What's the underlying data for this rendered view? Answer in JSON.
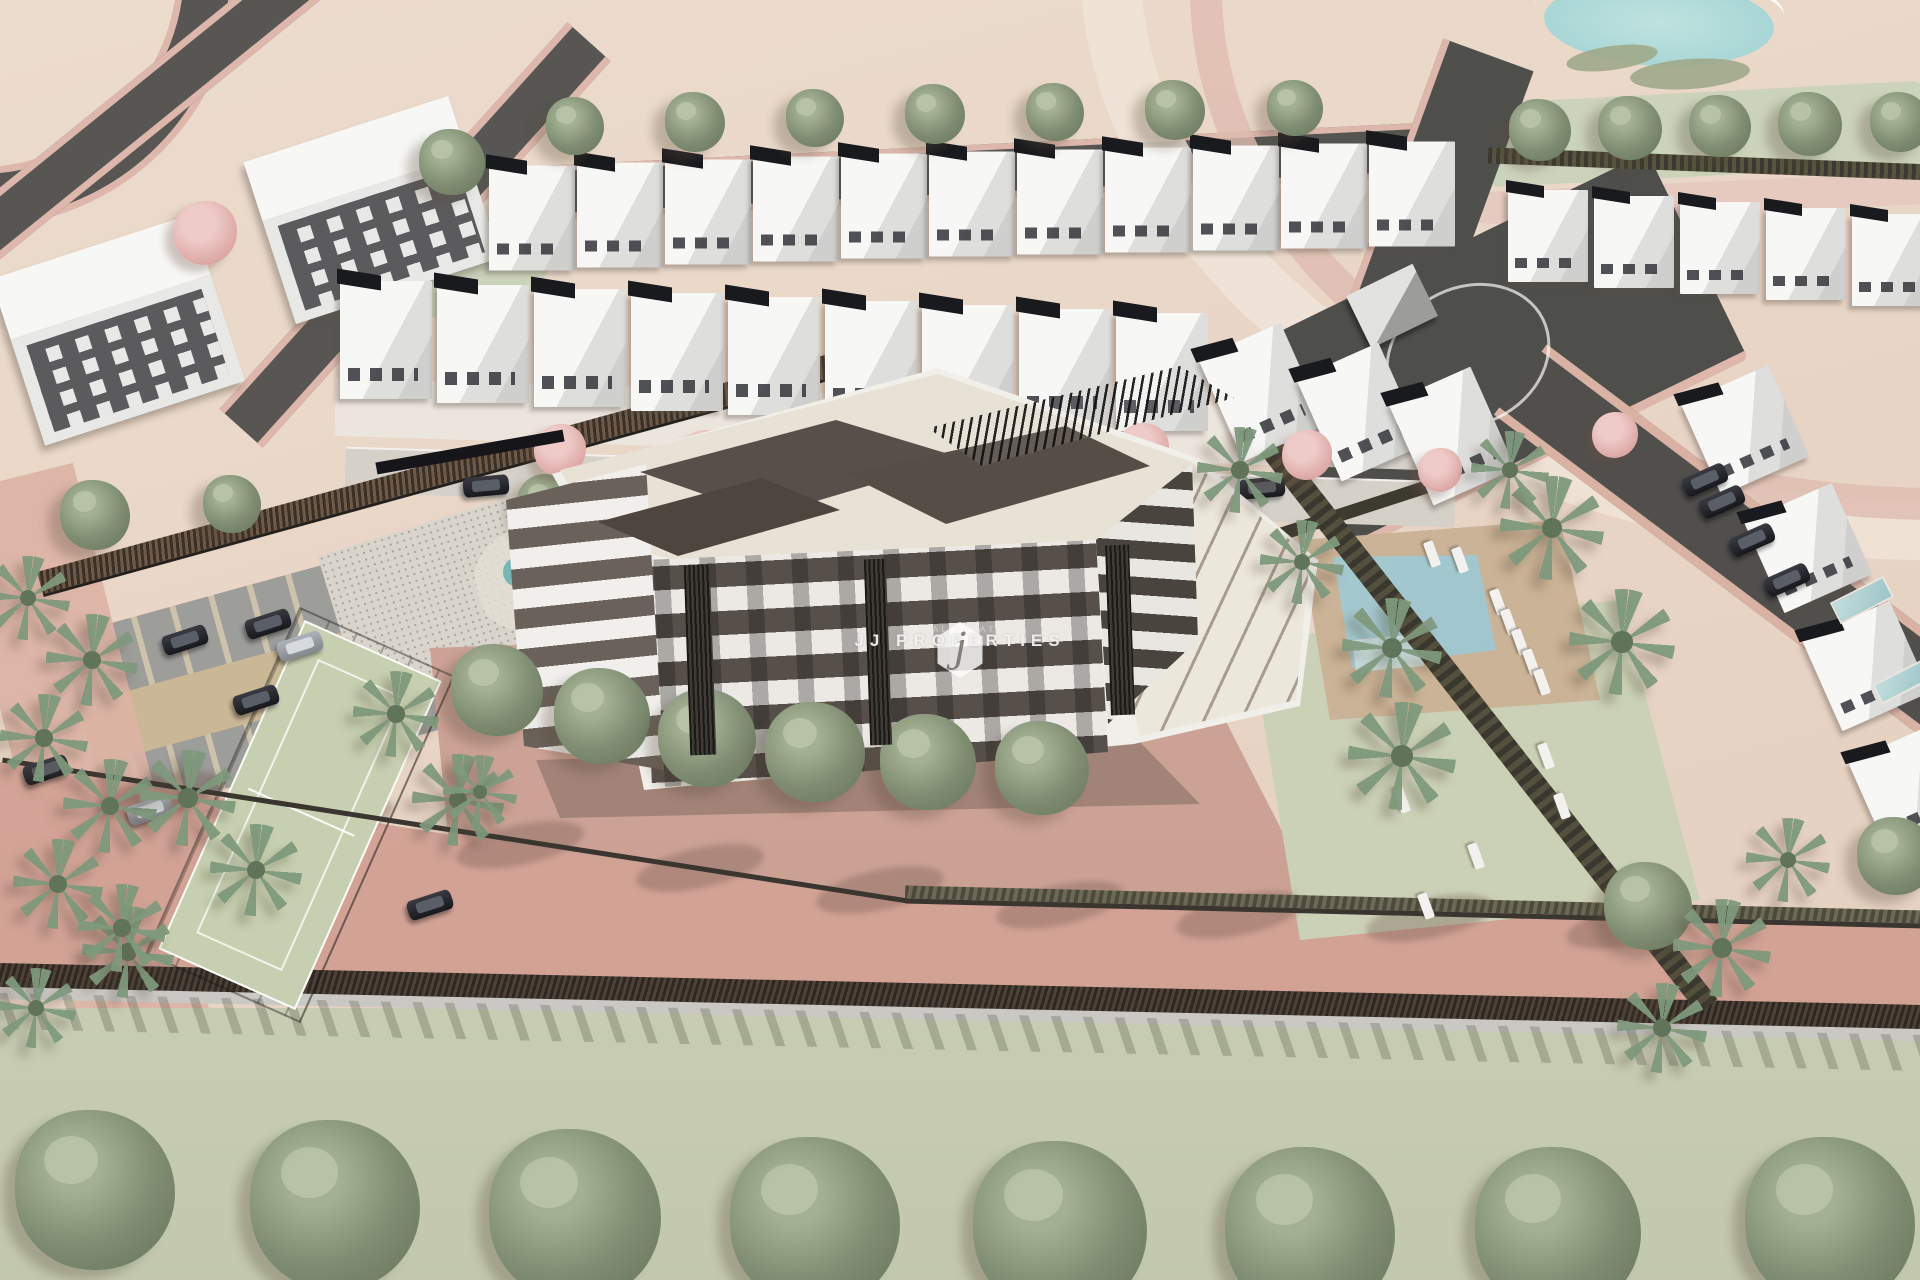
{
  "image": {
    "width": 1920,
    "height": 1280,
    "description": "Aerial 3D architectural rendering of a residential development: a central apartment building with cream roof terrace and brown penthouse volumes, surrounded by rows of white villas, a communal pool with sun loungers and palm trees, a paddle court, a parking lot with cars, playground, roads and a large green field along the bottom."
  },
  "watermark": {
    "logo_letter": "j",
    "brand": "JJ PROPERTIES",
    "tagline": "REAL ESTATE"
  },
  "palette": {
    "terrain": "#e8d5c5",
    "terrain_hi": "#ecdccd",
    "terrain_lo": "#e3cfbf",
    "road": "#575653",
    "sidewalk": "#ddb7ab",
    "roof_dark": "#191a1e",
    "tree": "#7f8d72",
    "flower": "#dda9a6",
    "field_green": "#ccd3bb",
    "roof_cream": "#e8e2d4",
    "brown": "#57504a",
    "pool": "#93bcc6",
    "deck": "#cab396",
    "lawn": "#cbd1b6",
    "stall": "#9d9d9a",
    "lane": "#c9b795",
    "court": "#c6d0b0",
    "walk_pink": "#dcb2a4",
    "pave_pink": "#cfa89a",
    "road_salmon": "#d6a89a",
    "wall_dark": "#4e4238",
    "wall_light": "#cac8c4",
    "field_bottom": "#c7ccb2",
    "sand": "#d9bd92"
  },
  "scene": {
    "sprites": [
      {
        "cls": "apt",
        "x": 372,
        "y": 210,
        "w": 215,
        "h": 170,
        "r": -18
      },
      {
        "cls": "apt",
        "x": 118,
        "y": 330,
        "w": 210,
        "h": 175,
        "r": -18
      },
      {
        "cls": "villa",
        "x": 532,
        "y": 218
      },
      {
        "cls": "villa",
        "x": 620,
        "y": 215
      },
      {
        "cls": "villa",
        "x": 708,
        "y": 212
      },
      {
        "cls": "villa",
        "x": 796,
        "y": 209
      },
      {
        "cls": "villa",
        "x": 884,
        "y": 206
      },
      {
        "cls": "villa",
        "x": 972,
        "y": 204
      },
      {
        "cls": "villa",
        "x": 1060,
        "y": 202
      },
      {
        "cls": "villa",
        "x": 1148,
        "y": 200
      },
      {
        "cls": "villa",
        "x": 1236,
        "y": 198
      },
      {
        "cls": "villa",
        "x": 1324,
        "y": 196
      },
      {
        "cls": "villa",
        "x": 1412,
        "y": 194
      },
      {
        "cls": "villa",
        "x": 386,
        "y": 340,
        "w": 92,
        "h": 118
      },
      {
        "cls": "villa",
        "x": 483,
        "y": 344,
        "w": 92,
        "h": 118
      },
      {
        "cls": "villa",
        "x": 580,
        "y": 348,
        "w": 92,
        "h": 118
      },
      {
        "cls": "villa",
        "x": 677,
        "y": 352,
        "w": 92,
        "h": 118
      },
      {
        "cls": "villa",
        "x": 774,
        "y": 356,
        "w": 92,
        "h": 118
      },
      {
        "cls": "villa",
        "x": 871,
        "y": 360,
        "w": 92,
        "h": 118
      },
      {
        "cls": "villa",
        "x": 968,
        "y": 364,
        "w": 92,
        "h": 118
      },
      {
        "cls": "villa",
        "x": 1065,
        "y": 368,
        "w": 92,
        "h": 118
      },
      {
        "cls": "villa",
        "x": 1162,
        "y": 372,
        "w": 92,
        "h": 118
      },
      {
        "cls": "villa",
        "x": 1262,
        "y": 392,
        "w": 90,
        "h": 112,
        "r": -24
      },
      {
        "cls": "villa",
        "x": 1360,
        "y": 412,
        "w": 90,
        "h": 112,
        "r": -24
      },
      {
        "cls": "villa",
        "x": 1452,
        "y": 436,
        "w": 90,
        "h": 112,
        "r": -24
      },
      {
        "cls": "villa",
        "x": 1548,
        "y": 236,
        "w": 80,
        "h": 92
      },
      {
        "cls": "villa",
        "x": 1634,
        "y": 242,
        "w": 80,
        "h": 92
      },
      {
        "cls": "villa",
        "x": 1720,
        "y": 248,
        "w": 80,
        "h": 92
      },
      {
        "cls": "villa",
        "x": 1806,
        "y": 254,
        "w": 80,
        "h": 92
      },
      {
        "cls": "villa",
        "x": 1892,
        "y": 260,
        "w": 80,
        "h": 92
      },
      {
        "cls": "villa",
        "x": 1745,
        "y": 430,
        "w": 96,
        "h": 100,
        "r": -24
      },
      {
        "cls": "villa",
        "x": 1808,
        "y": 548,
        "w": 96,
        "h": 100,
        "r": -24
      },
      {
        "cls": "villa",
        "x": 1866,
        "y": 666,
        "w": 96,
        "h": 100,
        "r": -24
      },
      {
        "cls": "villa",
        "x": 1912,
        "y": 788,
        "w": 96,
        "h": 100,
        "r": -24
      },
      {
        "cls": "tree",
        "x": 575,
        "y": 126,
        "w": 58,
        "h": 58
      },
      {
        "cls": "tree",
        "x": 695,
        "y": 122,
        "w": 60,
        "h": 60
      },
      {
        "cls": "tree",
        "x": 815,
        "y": 118,
        "w": 58,
        "h": 58
      },
      {
        "cls": "tree",
        "x": 935,
        "y": 114,
        "w": 60,
        "h": 60
      },
      {
        "cls": "tree",
        "x": 1055,
        "y": 112,
        "w": 58,
        "h": 58
      },
      {
        "cls": "tree",
        "x": 1175,
        "y": 110,
        "w": 60,
        "h": 60
      },
      {
        "cls": "tree",
        "x": 1295,
        "y": 108,
        "w": 56,
        "h": 56
      },
      {
        "cls": "tree",
        "x": 1540,
        "y": 130,
        "w": 62,
        "h": 62
      },
      {
        "cls": "tree",
        "x": 1630,
        "y": 128,
        "w": 64,
        "h": 64
      },
      {
        "cls": "tree",
        "x": 1720,
        "y": 126,
        "w": 62,
        "h": 62
      },
      {
        "cls": "tree",
        "x": 1810,
        "y": 124,
        "w": 64,
        "h": 64
      },
      {
        "cls": "tree",
        "x": 1900,
        "y": 122,
        "w": 60,
        "h": 60
      },
      {
        "cls": "tree",
        "x": 452,
        "y": 162,
        "w": 66,
        "h": 66
      },
      {
        "cls": "tree",
        "x": 548,
        "y": 505,
        "w": 62,
        "h": 62
      },
      {
        "cls": "tree",
        "x": 95,
        "y": 515,
        "w": 70,
        "h": 70
      },
      {
        "cls": "tree",
        "x": 232,
        "y": 504,
        "w": 58,
        "h": 58
      },
      {
        "cls": "tree",
        "x": 497,
        "y": 690,
        "w": 92,
        "h": 92,
        "z": 5
      },
      {
        "cls": "tree",
        "x": 602,
        "y": 716,
        "w": 96,
        "h": 96,
        "z": 5
      },
      {
        "cls": "tree",
        "x": 707,
        "y": 738,
        "w": 98,
        "h": 98,
        "z": 5
      },
      {
        "cls": "tree",
        "x": 815,
        "y": 752,
        "w": 100,
        "h": 100,
        "z": 5
      },
      {
        "cls": "tree",
        "x": 928,
        "y": 762,
        "w": 96,
        "h": 96,
        "z": 5
      },
      {
        "cls": "tree",
        "x": 1042,
        "y": 768,
        "w": 94,
        "h": 94,
        "z": 5
      },
      {
        "cls": "tree",
        "x": 1188,
        "y": 642,
        "w": 78,
        "h": 78
      },
      {
        "cls": "tree",
        "x": 1250,
        "y": 560,
        "w": 54,
        "h": 54
      },
      {
        "cls": "tree",
        "x": 1648,
        "y": 906,
        "w": 88,
        "h": 88
      },
      {
        "cls": "tree",
        "x": 1896,
        "y": 856,
        "w": 78,
        "h": 78
      },
      {
        "cls": "tree",
        "x": 95,
        "y": 1190,
        "w": 160,
        "h": 160,
        "z": 6
      },
      {
        "cls": "tree",
        "x": 335,
        "y": 1205,
        "w": 170,
        "h": 170,
        "z": 6
      },
      {
        "cls": "tree",
        "x": 575,
        "y": 1215,
        "w": 172,
        "h": 172,
        "z": 6
      },
      {
        "cls": "tree",
        "x": 815,
        "y": 1222,
        "w": 170,
        "h": 170,
        "z": 6
      },
      {
        "cls": "tree",
        "x": 1060,
        "y": 1228,
        "w": 174,
        "h": 174,
        "z": 6
      },
      {
        "cls": "tree",
        "x": 1310,
        "y": 1232,
        "w": 170,
        "h": 170,
        "z": 6
      },
      {
        "cls": "tree",
        "x": 1558,
        "y": 1230,
        "w": 166,
        "h": 166,
        "z": 6
      },
      {
        "cls": "tree",
        "x": 1830,
        "y": 1222,
        "w": 170,
        "h": 170,
        "z": 6
      },
      {
        "cls": "ftree",
        "x": 205,
        "y": 233,
        "w": 64,
        "h": 64
      },
      {
        "cls": "ftree",
        "x": 560,
        "y": 450,
        "w": 52,
        "h": 52
      },
      {
        "cls": "ftree",
        "x": 705,
        "y": 455,
        "w": 50,
        "h": 50
      },
      {
        "cls": "ftree",
        "x": 783,
        "y": 446,
        "w": 44,
        "h": 44
      },
      {
        "cls": "ftree",
        "x": 908,
        "y": 442,
        "w": 42,
        "h": 42
      },
      {
        "cls": "ftree",
        "x": 1005,
        "y": 460,
        "w": 50,
        "h": 50
      },
      {
        "cls": "ftree",
        "x": 1143,
        "y": 449,
        "w": 52,
        "h": 52
      },
      {
        "cls": "ftree",
        "x": 1307,
        "y": 455,
        "w": 50,
        "h": 50
      },
      {
        "cls": "ftree",
        "x": 1440,
        "y": 470,
        "w": 44,
        "h": 44
      },
      {
        "cls": "ftree",
        "x": 1615,
        "y": 435,
        "w": 46,
        "h": 46
      },
      {
        "cls": "palm",
        "x": 28,
        "y": 598,
        "w": 84,
        "h": 84,
        "z": 4
      },
      {
        "cls": "palm",
        "x": 92,
        "y": 660,
        "w": 92,
        "h": 92,
        "z": 4
      },
      {
        "cls": "palm",
        "x": 44,
        "y": 738,
        "w": 88,
        "h": 88,
        "z": 4
      },
      {
        "cls": "palm",
        "x": 110,
        "y": 806,
        "w": 94,
        "h": 94,
        "z": 4
      },
      {
        "cls": "palm",
        "x": 58,
        "y": 884,
        "w": 90,
        "h": 90,
        "z": 4
      },
      {
        "cls": "palm",
        "x": 128,
        "y": 952,
        "w": 92,
        "h": 92,
        "z": 4
      },
      {
        "cls": "palm",
        "x": 36,
        "y": 1008,
        "w": 80,
        "h": 80,
        "z": 4
      },
      {
        "cls": "palm",
        "x": 396,
        "y": 714,
        "w": 86,
        "h": 86,
        "z": 4
      },
      {
        "cls": "palm",
        "x": 458,
        "y": 800,
        "w": 92,
        "h": 92,
        "z": 4
      },
      {
        "cls": "palm",
        "x": 188,
        "y": 798,
        "w": 96,
        "h": 96,
        "z": 4
      },
      {
        "cls": "palm",
        "x": 256,
        "y": 870,
        "w": 92,
        "h": 92,
        "z": 4
      },
      {
        "cls": "palm",
        "x": 122,
        "y": 928,
        "w": 88,
        "h": 88,
        "z": 4
      },
      {
        "cls": "palm",
        "x": 1552,
        "y": 528,
        "w": 104,
        "h": 104,
        "z": 4
      },
      {
        "cls": "palm",
        "x": 1392,
        "y": 648,
        "w": 100,
        "h": 100,
        "z": 4
      },
      {
        "cls": "palm",
        "x": 1402,
        "y": 756,
        "w": 108,
        "h": 108,
        "z": 4
      },
      {
        "cls": "palm",
        "x": 1622,
        "y": 642,
        "w": 106,
        "h": 106,
        "z": 4
      },
      {
        "cls": "palm",
        "x": 1302,
        "y": 562,
        "w": 84,
        "h": 84,
        "z": 4
      },
      {
        "cls": "palm",
        "x": 1510,
        "y": 470,
        "w": 78,
        "h": 78,
        "z": 4
      },
      {
        "cls": "palm",
        "x": 1240,
        "y": 470,
        "w": 86,
        "h": 86,
        "z": 4
      },
      {
        "cls": "palm",
        "x": 1722,
        "y": 948,
        "w": 98,
        "h": 98,
        "z": 4
      },
      {
        "cls": "palm",
        "x": 1662,
        "y": 1028,
        "w": 90,
        "h": 90,
        "z": 4
      },
      {
        "cls": "palm",
        "x": 1788,
        "y": 860,
        "w": 84,
        "h": 84,
        "z": 4
      },
      {
        "cls": "palm",
        "x": 480,
        "y": 792,
        "w": 74,
        "h": 74,
        "z": 5
      },
      {
        "cls": "car",
        "x": 185,
        "y": 640,
        "r": -18
      },
      {
        "cls": "car",
        "x": 268,
        "y": 624,
        "r": -18
      },
      {
        "cls": "car car-s",
        "x": 300,
        "y": 646,
        "r": -18
      },
      {
        "cls": "car",
        "x": 256,
        "y": 700,
        "r": -18
      },
      {
        "cls": "car",
        "x": 46,
        "y": 770,
        "r": -18
      },
      {
        "cls": "car car-s",
        "x": 150,
        "y": 810,
        "r": -18
      },
      {
        "cls": "car",
        "x": 430,
        "y": 905,
        "r": -18
      },
      {
        "cls": "car",
        "x": 1705,
        "y": 480,
        "r": -24
      },
      {
        "cls": "car",
        "x": 1722,
        "y": 502,
        "r": -24
      },
      {
        "cls": "car",
        "x": 1752,
        "y": 540,
        "r": -24
      },
      {
        "cls": "car",
        "x": 1787,
        "y": 580,
        "r": -24
      },
      {
        "cls": "car",
        "x": 486,
        "y": 486,
        "r": -5
      },
      {
        "cls": "car",
        "x": 1116,
        "y": 477,
        "r": -5
      },
      {
        "cls": "car",
        "x": 1262,
        "y": 488,
        "r": -5
      },
      {
        "cls": "lounger",
        "x": 1498,
        "y": 602,
        "r": 70
      },
      {
        "cls": "lounger",
        "x": 1509,
        "y": 622,
        "r": 70
      },
      {
        "cls": "lounger",
        "x": 1520,
        "y": 642,
        "r": 70
      },
      {
        "cls": "lounger",
        "x": 1531,
        "y": 662,
        "r": 70
      },
      {
        "cls": "lounger",
        "x": 1542,
        "y": 682,
        "r": 70
      },
      {
        "cls": "lounger",
        "x": 1432,
        "y": 554,
        "r": 70
      },
      {
        "cls": "lounger",
        "x": 1460,
        "y": 560,
        "r": 70
      },
      {
        "cls": "lounger",
        "x": 1546,
        "y": 756,
        "r": 70
      },
      {
        "cls": "lounger",
        "x": 1402,
        "y": 800,
        "r": 70
      },
      {
        "cls": "lounger",
        "x": 1562,
        "y": 806,
        "r": 70
      },
      {
        "cls": "lounger",
        "x": 1476,
        "y": 856,
        "r": 70
      },
      {
        "cls": "lounger",
        "x": 1426,
        "y": 906,
        "r": 70
      },
      {
        "cls": "tshadow",
        "x": 160,
        "y": 795,
        "r": -12,
        "z": 2
      },
      {
        "cls": "tshadow",
        "x": 330,
        "y": 820,
        "r": -12,
        "z": 2
      },
      {
        "cls": "tshadow",
        "x": 520,
        "y": 845,
        "r": -12,
        "z": 2
      },
      {
        "cls": "tshadow",
        "x": 700,
        "y": 868,
        "r": -12,
        "z": 2
      },
      {
        "cls": "tshadow",
        "x": 880,
        "y": 890,
        "r": -12,
        "z": 2
      },
      {
        "cls": "tshadow",
        "x": 1060,
        "y": 905,
        "r": -12,
        "z": 2
      },
      {
        "cls": "tshadow",
        "x": 1240,
        "y": 915,
        "r": -12,
        "z": 2
      },
      {
        "cls": "tshadow",
        "x": 1430,
        "y": 918,
        "r": -12,
        "z": 2
      },
      {
        "cls": "tshadow",
        "x": 1630,
        "y": 925,
        "r": -12,
        "z": 2
      },
      {
        "cls": "vpool",
        "x": 1862,
        "y": 600,
        "w": 60,
        "h": 24,
        "r": -27
      },
      {
        "cls": "vpool",
        "x": 1902,
        "y": 682,
        "w": 56,
        "h": 22,
        "r": -27
      },
      {
        "cls": "vpool",
        "x": 1268,
        "y": 596,
        "w": 34,
        "h": 86,
        "r": -14
      },
      {
        "cls": "gisland",
        "x": 1612,
        "y": 58,
        "w": 92,
        "h": 24,
        "r": -8,
        "z": 1
      },
      {
        "cls": "gisland",
        "x": 1690,
        "y": 74,
        "w": 120,
        "h": 30,
        "r": -4,
        "z": 1
      },
      {
        "cls": "pg-base",
        "x": 565,
        "y": 570,
        "w": 180,
        "h": 110,
        "r": -15,
        "z": 2
      },
      {
        "cls": "pg-sand",
        "x": 590,
        "y": 570,
        "w": 50,
        "h": 50,
        "z": 3
      },
      {
        "cls": "pg-sand",
        "x": 620,
        "y": 548,
        "w": 24,
        "h": 24,
        "z": 3
      },
      {
        "cls": "pg-teal",
        "x": 518,
        "y": 572,
        "w": 30,
        "h": 30,
        "z": 3
      },
      {
        "cls": "pg-red",
        "x": 548,
        "y": 590,
        "w": 22,
        "h": 22,
        "z": 3
      },
      {
        "cls": "gate",
        "x": 470,
        "y": 452,
        "w": 190,
        "h": 12,
        "r": -10,
        "z": 3
      },
      {
        "cls": "louver",
        "x": 700,
        "y": 660,
        "w": 26,
        "h": 190,
        "r": -2,
        "z": 5
      },
      {
        "cls": "louver",
        "x": 878,
        "y": 652,
        "w": 22,
        "h": 186,
        "r": -2,
        "z": 5
      },
      {
        "cls": "louver",
        "x": 1120,
        "y": 630,
        "w": 24,
        "h": 170,
        "r": -2,
        "z": 5
      }
    ]
  }
}
